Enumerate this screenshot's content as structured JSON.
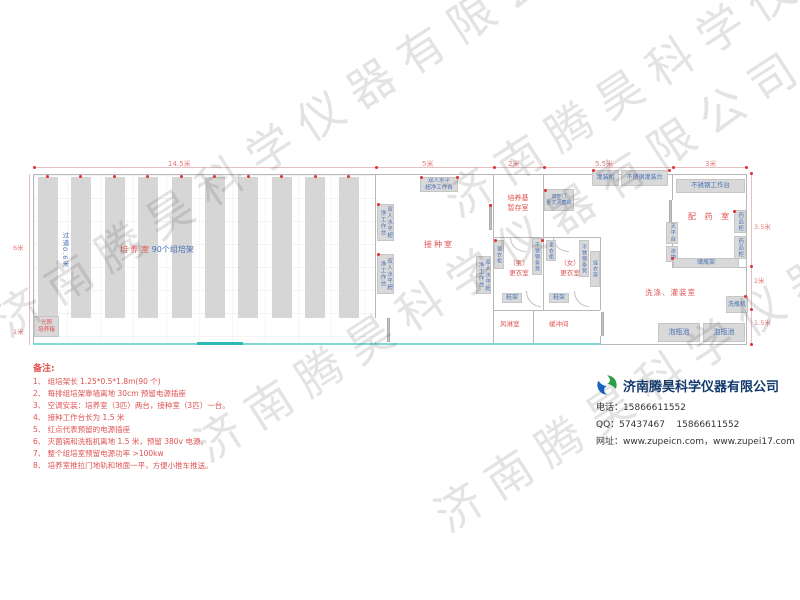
{
  "watermark": {
    "text": "济南腾昊科学仪器有限公司"
  },
  "dimensions": {
    "top_total": "14.5米",
    "top_inoculation": "5米",
    "top_medium": "2米",
    "top_washing": "5.5米",
    "top_pharmacy": "3米",
    "left_main": "6米",
    "left_bottom": "1米",
    "right_pharmacy": "3.5米",
    "right_washing": "2米",
    "right_pool": "1.5米"
  },
  "culture_room": {
    "label_red": "培 养 室",
    "label_blue": "90个组培架",
    "aisle": "过道0.6米",
    "incubator_line1": "光照",
    "incubator_line2": "培养箱"
  },
  "inoculation_room": {
    "label": "接种室",
    "bench_line1": "双人水平",
    "bench_line2": "超净工作台",
    "bench_vertical": "双人水平超净工作台"
  },
  "medium_room": {
    "label_line1": "培养基",
    "label_line2": "暂存室",
    "sterilizer_line1": "双开门",
    "sterilizer_line2": "卧式灭菌锅"
  },
  "changing_area": {
    "male_line1": "（男）",
    "male_line2": "更衣室",
    "female_line1": "（女）",
    "female_line2": "更衣室",
    "wardrobe": "更衣柜",
    "bench": "不锈钢条凳",
    "coat_rack": "挂衣架",
    "shoe_rack": "鞋架",
    "air_shower": "风淋室",
    "buffer_room": "缓冲间"
  },
  "pharmacy_room": {
    "label": "配 药 室",
    "worktable": "不锈钢工作台",
    "medicine_cabinet": "药品柜",
    "balance_table": "天平台",
    "fridge": "冰箱",
    "bottle_rack": "储瓶架"
  },
  "washing_room": {
    "label": "洗涤、灌装室",
    "filling_machine": "灌装机",
    "filling_table": "不锈钢灌装台",
    "bottle_washer": "洗瓶机",
    "soak_pool": "泡瓶池"
  },
  "notes": {
    "title": "备注:",
    "items": [
      "1、 组培架长 1.25*0.5*1.8m(90 个)",
      "2、 每排组培架靠墙离地 30cm 预留电源插座",
      "3、 空调安装：培养室（3匹）两台，接种室（3匹）一台。",
      "4、 接种工作台长为 1.5 米",
      "5、 红点代表预留的电源插座",
      "6、 灭菌锅和洗瓶机离地 1.5 米，预留 380v 电源。",
      "7、 整个组培室预留电源功率 >100kw",
      "8、 培养室推拉门地轨和地面一平，方便小推车推送。"
    ]
  },
  "company": {
    "name": "济南腾昊科学仪器有限公司",
    "phone_label": "电话：",
    "phone": "15866611552",
    "qq_label": "QQ：",
    "qq": "57437467    15866611552",
    "web_label": "网址：",
    "web": "www.zupeicn.com，www.zupei17.com"
  },
  "colors": {
    "room_label_red": "#e05252",
    "equipment_label_blue": "#4a72b8",
    "dimension_red": "#e87878",
    "wall_gray": "#b8b8b8",
    "equipment_fill": "#d9d9d9",
    "teal_wall": "#7fd8d5",
    "outlet_dot_red": "#e03030",
    "company_name_navy": "#123a6e",
    "logo_blue": "#1565c0",
    "logo_green": "#2e9e48"
  }
}
